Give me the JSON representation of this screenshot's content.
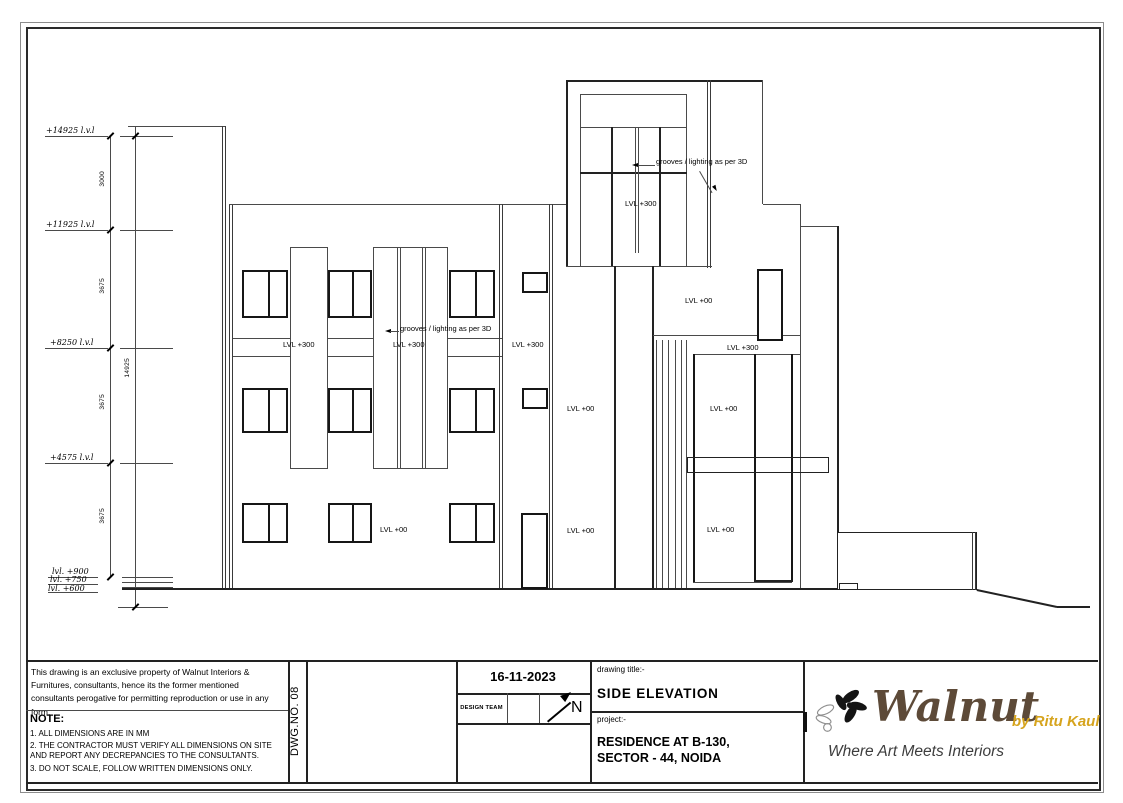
{
  "drawing": {
    "levels": [
      {
        "label": "+14925 l.v.l"
      },
      {
        "label": "+11925 l.v.l"
      },
      {
        "label": "+8250 l.v.l"
      },
      {
        "label": "+4575 l.v.l"
      },
      {
        "label": "lvl. +900"
      },
      {
        "label": "lvl. +750"
      },
      {
        "label": "lvl. +600"
      }
    ],
    "dims": {
      "seg1": "3000",
      "seg2": "3675",
      "seg3": "3675",
      "seg4": "3675",
      "overall": "14925"
    },
    "labels": {
      "lvl300": "LVL +300",
      "lvl00": "LVL +00",
      "grooves": "grooves / lighting as per 3D"
    }
  },
  "titleblock": {
    "copyright": "This drawing is an exclusive property of Walnut Interiors & Furnitures, consultants, hence its the former mentioned consultants perogative for permitting reproduction or use in any form.",
    "note_heading": "NOTE:",
    "notes": [
      "1. ALL DIMENSIONS ARE IN MM",
      "2. THE CONTRACTOR MUST VERIFY ALL DIMENSIONS ON SITE  AND REPORT ANY DECREPANCIES TO THE CONSULTANTS.",
      "3. DO NOT SCALE, FOLLOW WRITTEN DIMENSIONS ONLY."
    ],
    "dwg_no": "DWG.NO. 08",
    "date": "16-11-2023",
    "design_team": "DESIGN TEAM",
    "north": "N",
    "drawing_title_label": "drawing title:-",
    "drawing_title": "SIDE ELEVATION",
    "project_label": "project:-",
    "project_line1": "RESIDENCE AT B-130,",
    "project_line2": "SECTOR - 44, NOIDA",
    "brand": {
      "name": "Walnut",
      "byline": "by Ritu Kaul",
      "tagline": "Where Art Meets Interiors",
      "brand_color": "#5d4a38",
      "byline_color": "#d6a41e"
    }
  }
}
